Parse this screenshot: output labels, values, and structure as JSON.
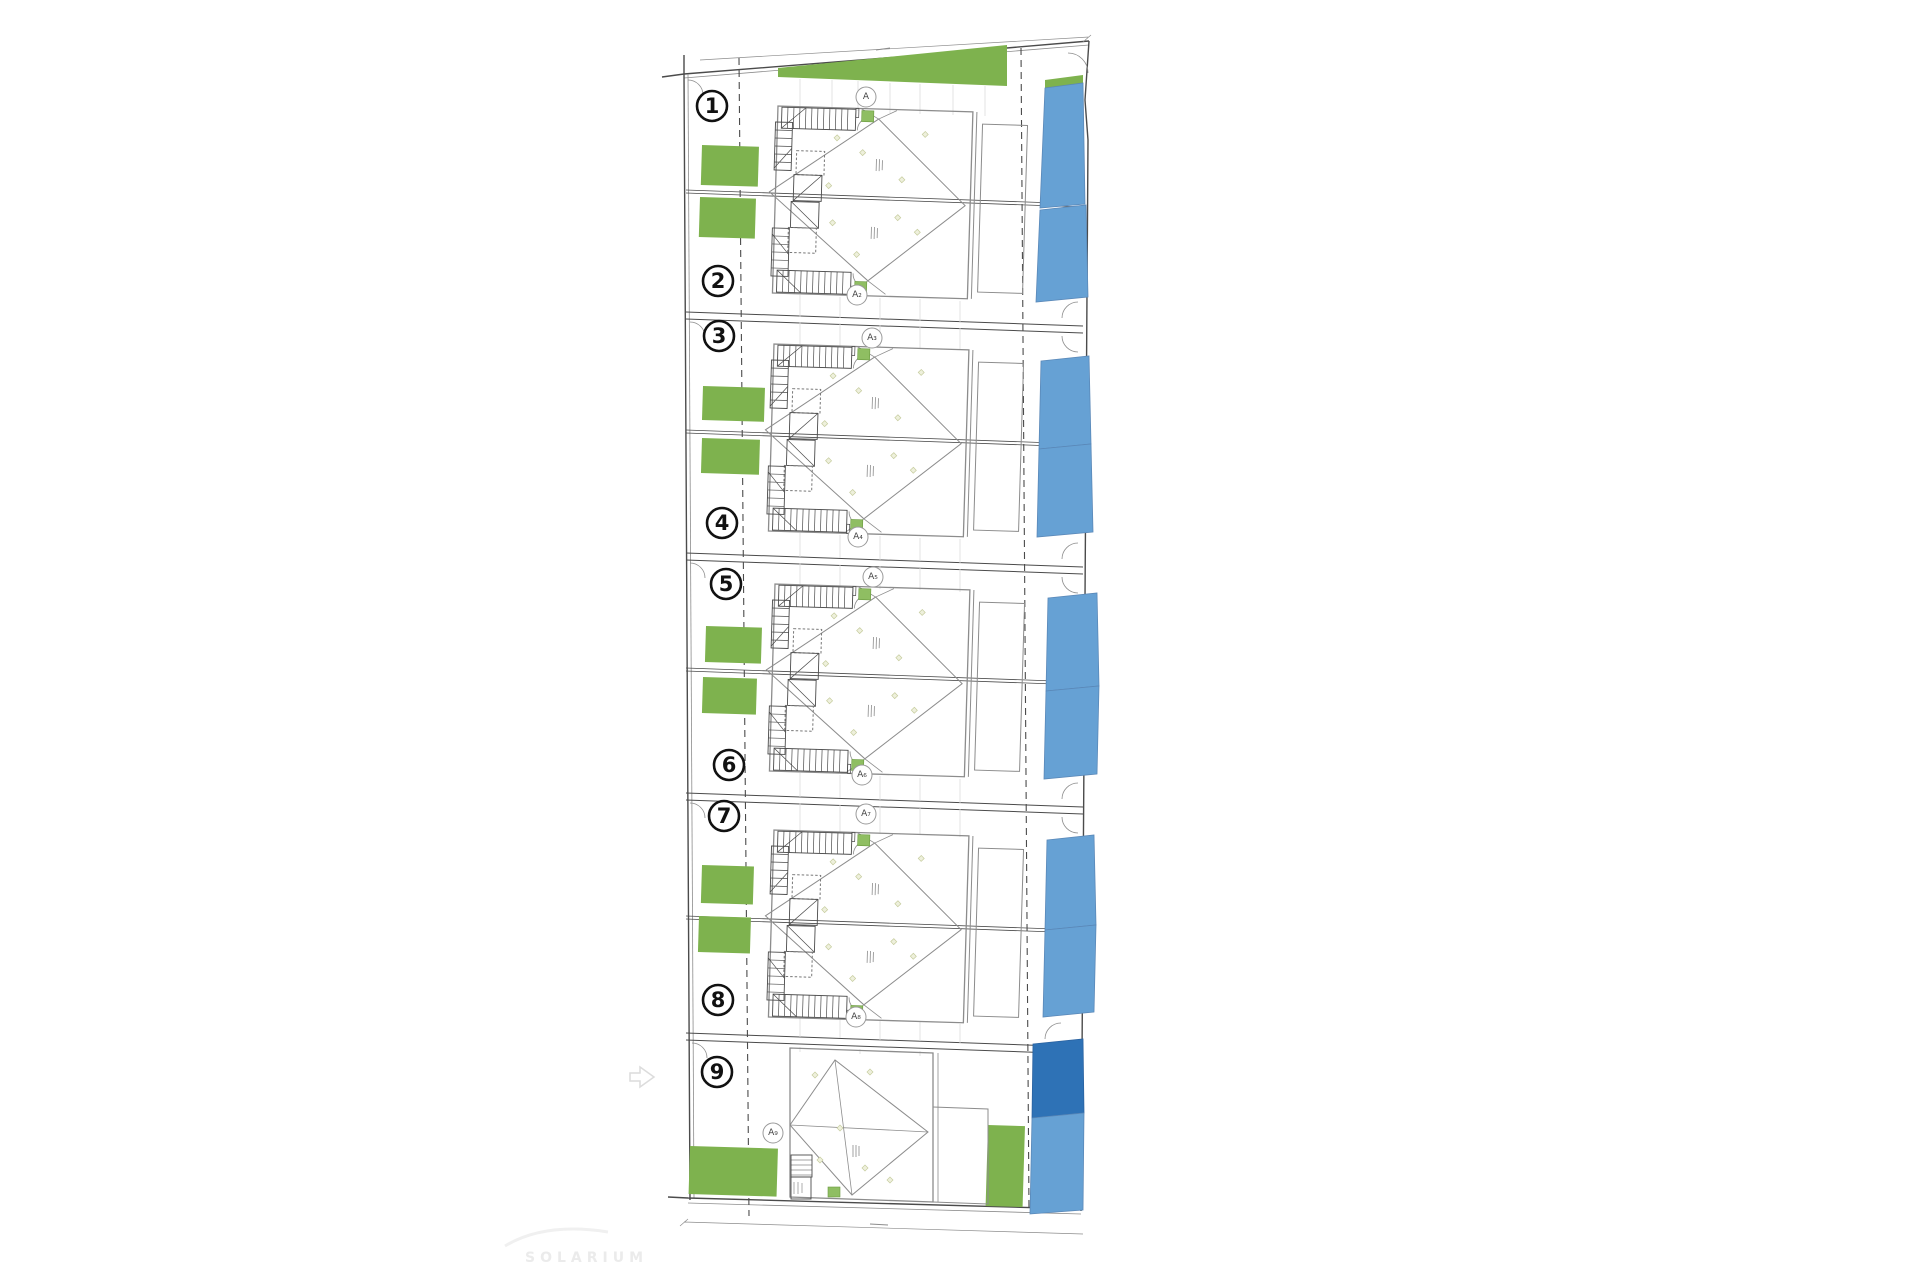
{
  "watermark": {
    "text": "SOLARIUM"
  },
  "plots": [
    {
      "number": "1"
    },
    {
      "number": "2"
    },
    {
      "number": "3"
    },
    {
      "number": "4"
    },
    {
      "number": "5"
    },
    {
      "number": "6"
    },
    {
      "number": "7"
    },
    {
      "number": "8"
    },
    {
      "number": "9"
    }
  ],
  "section_markers": [
    {
      "label": "A"
    },
    {
      "label": "A₂"
    },
    {
      "label": "A₃"
    },
    {
      "label": "A₄"
    },
    {
      "label": "A₅"
    },
    {
      "label": "A₆"
    },
    {
      "label": "A₇"
    },
    {
      "label": "A₈"
    },
    {
      "label": "A₉"
    }
  ],
  "colors": {
    "garden": "#7eb24e",
    "pool": "#66a1d4",
    "pool_deep": "#2e72b6",
    "entry_green": "#8fbe62",
    "line_dark": "#4b4b4b",
    "line_mid": "#8c8c8c",
    "line_faint": "#dcdcdc",
    "watermark": "#ebebeb"
  }
}
